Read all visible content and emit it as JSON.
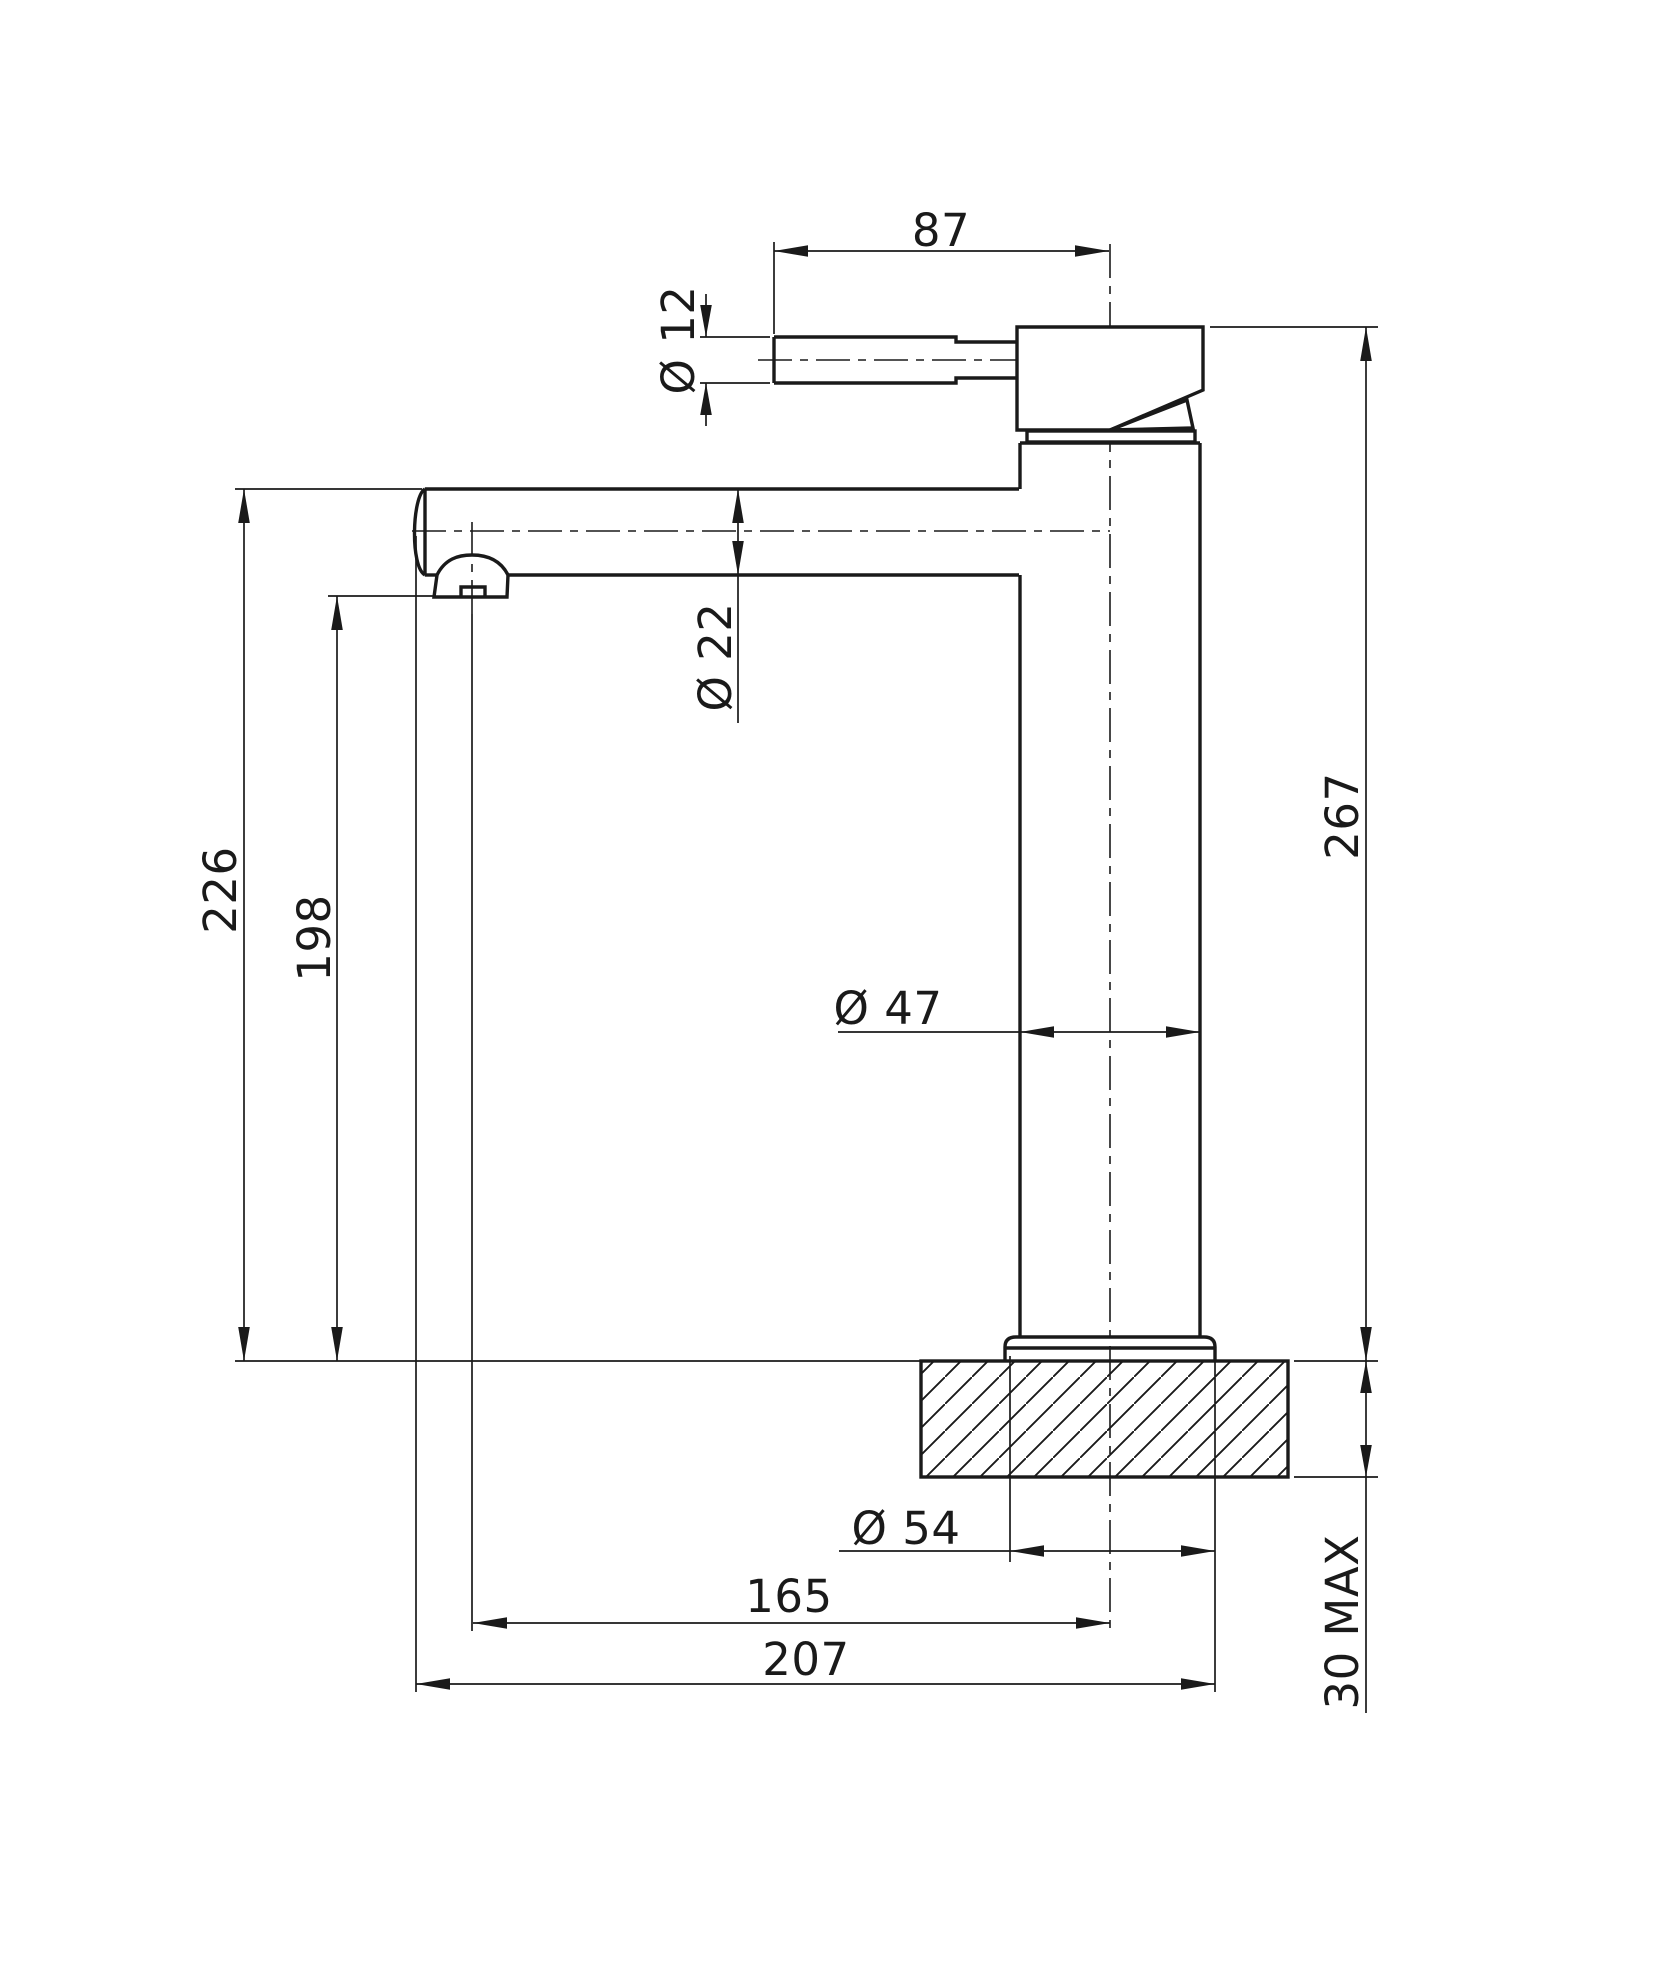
{
  "drawing": {
    "kind": "faucet-dimension-drawing",
    "colors": {
      "line": "#1a1a1a",
      "background": "#ffffff"
    },
    "dimensions": {
      "handle_length": "87",
      "handle_diameter": "Ø 12",
      "spout_diameter": "Ø 22",
      "spout_outlet_height": "198",
      "spout_top_height": "226",
      "overall_height": "267",
      "body_diameter": "Ø 47",
      "base_diameter": "Ø 54",
      "spout_reach": "165",
      "overall_reach": "207",
      "deck_thickness": "30 MAX"
    }
  }
}
